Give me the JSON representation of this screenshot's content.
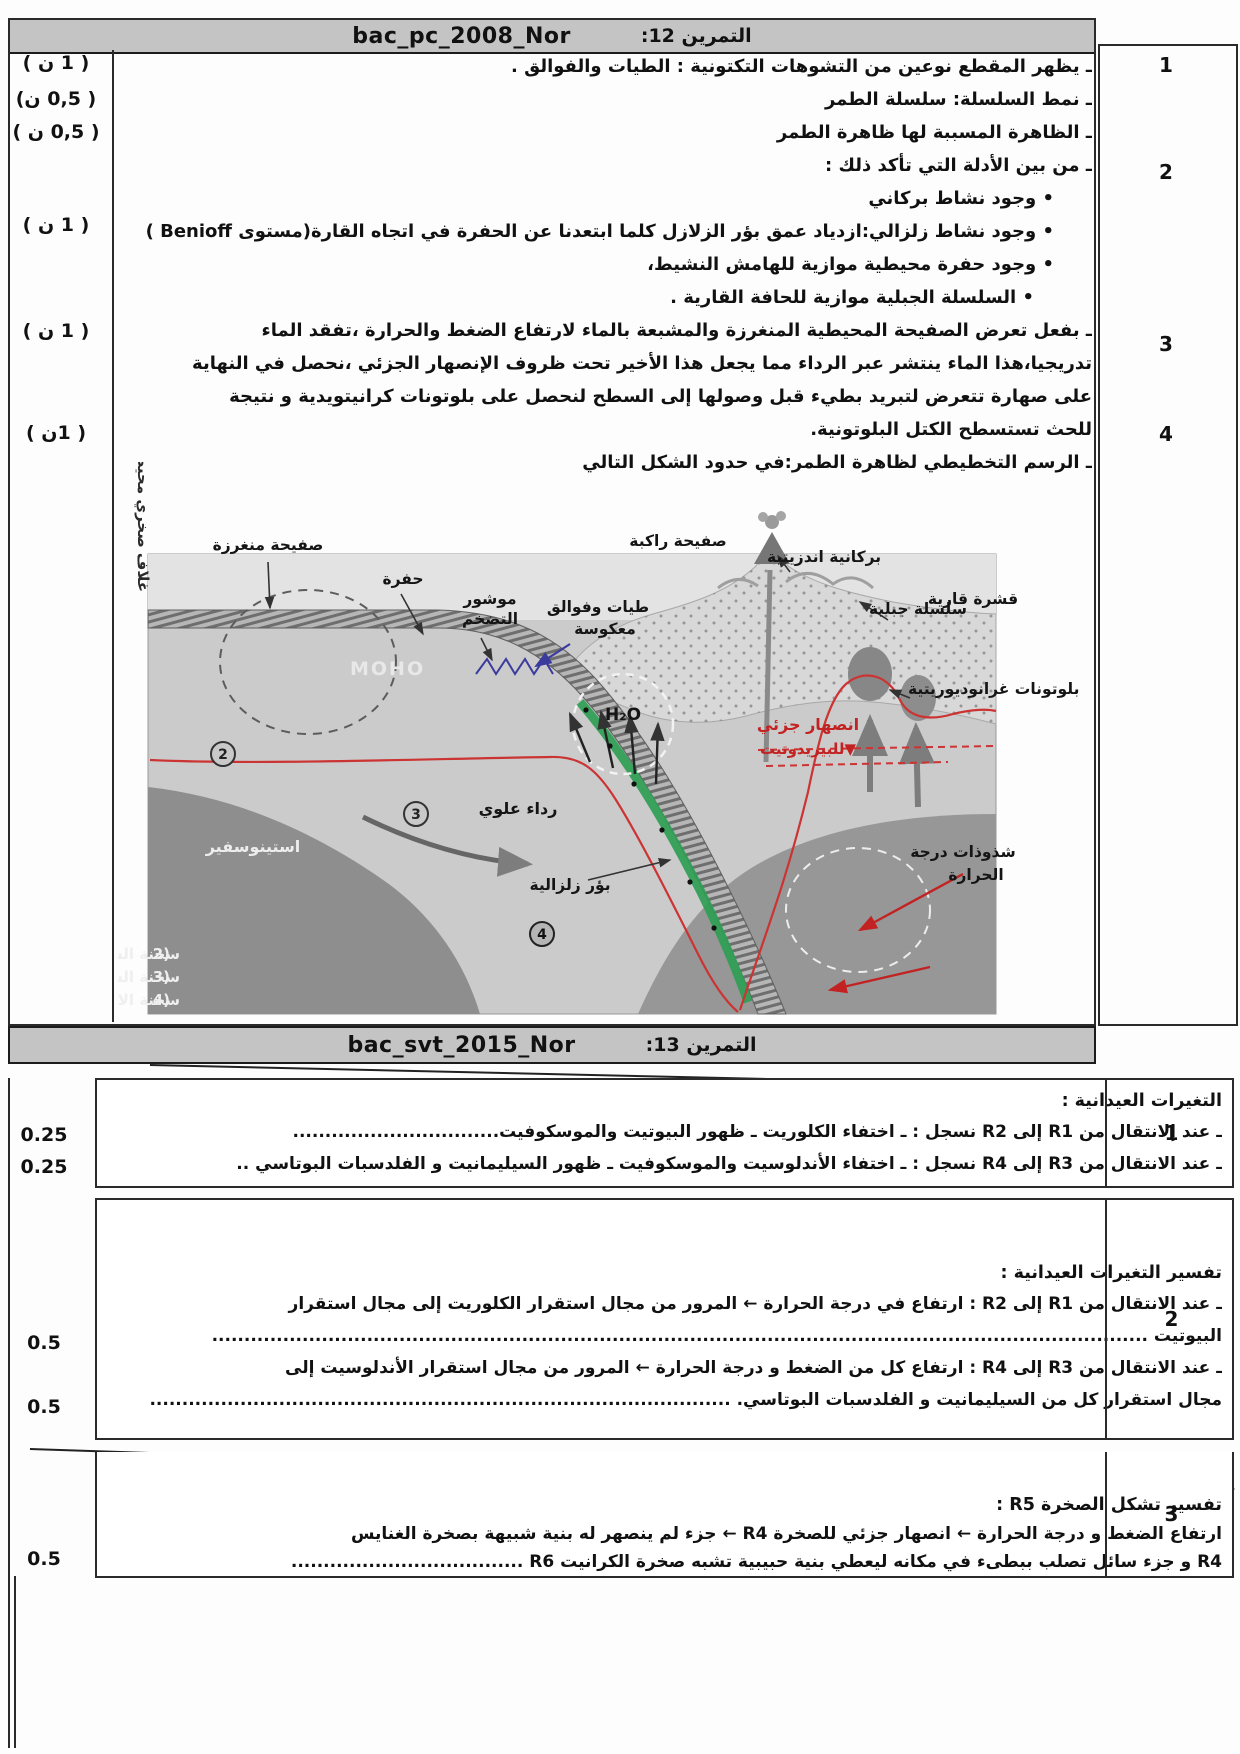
{
  "ex12": {
    "header": {
      "code": "bac_pc_2008_Nor",
      "label": "التمرين 12:"
    },
    "marks": [
      "( 1 ن )",
      "( 0,5 ن)",
      "( 0,5 ن )",
      "( 1 ن )",
      "( 1 ن )",
      "( 1ن )"
    ],
    "numbers": [
      "1",
      "2",
      "3",
      "4"
    ],
    "lines": [
      "ـ يظهر المقطع نوعين من التشوهات التكتونية : الطيات  والفوالق .",
      "ـ نمط السلسلة: سلسلة الطمر",
      "ـ  الظاهرة المسببة لها ظاهرة الطمر",
      "ـ من بين الأدلة التي تأكد ذلك :"
    ],
    "bullets": [
      "• وجود نشاط بركاني",
      "• وجود نشاط زلزالي:ازدياد عمق بؤر الزلازل كلما ابتعدنا عن الحفرة في اتجاه القارة(مستوى Benioff )",
      "• وجود حفرة محيطية موازية للهامش النشيط،",
      "•  السلسلة الجبلية موازية للحافة القارية ."
    ],
    "para": [
      "ـ بفعل تعرض الصفيحة المحيطية المنغرزة  والمشبعة بالماء لارتفاع الضغط والحرارة ،تفقد الماء",
      "تدريجيا،هذا الماء ينتشر عبر الرداء مما يجعل هذا الأخير تحت ظروف الإنصهار الجزئي ،نحصل في النهاية",
      "على صهارة  تتعرض لتبريد بطيء قبل وصولها إلى السطح لنحصل على بلوتونات كرانيتويدية و نتيجة",
      "للحث تستسطح الكتل البلوتونية.",
      "ـ الرسم التخطيطي لظاهرة الطمر:في حدود الشكل التالي"
    ],
    "diagram": {
      "plate_sub": "صفيحة منغرزة",
      "trench": "حفرة",
      "prism1": "موشور",
      "prism2": "التضخم",
      "folds1": "طيات وفوالق",
      "folds2": "معكوسة",
      "plate_over": "صفيحة راكبة",
      "volcanic": "بركانية اندزيتية",
      "chain": "سلسلة جبلية",
      "crust": "قشرة قارية",
      "plutons": "بلوتونات غرانوديوريتية",
      "melt1": "انصهار جزئي",
      "melt2": "▼للبيريدوتيت",
      "anomaly1": "شذوذات درجة",
      "anomaly2": "الحرارة",
      "h2o": "H₂O",
      "moho": "MOHO",
      "mantle": "رداء علوي",
      "foci": "بؤر زلزالية",
      "astheno": "استينوسفير",
      "litho": "غلاف صخري محيطي",
      "c2": "2",
      "c3": "3",
      "c4": "4",
      "legend": [
        {
          "num": "2)",
          "text": "سحنة الشيست الأخضر"
        },
        {
          "num": "3)",
          "text": "سحنة الشيست الازرق"
        },
        {
          "num": "4)",
          "text": "سحنة الاكلوجيت"
        }
      ]
    }
  },
  "ex13": {
    "header": {
      "code": "bac_svt_2015_Nor",
      "label": "التمرين 13:"
    },
    "rows": [
      {
        "num": "1",
        "title": "التغيرات العيدانية :",
        "lines": [
          {
            "text": "ـ عند إلانتقال من R1 إلى R2 نسجل : ـ اختفاء الكلوريت   ـ ظهور البيوتيت والموسكوفيت................................",
            "mark": "0.25"
          },
          {
            "text": "ـ عند الانتقال من R3 إلى R4 نسجل : ـ اختفاء الأندلوسيت والموسكوفيت   ـ ظهور السيليمانيت و الفلدسبات البوتاسي ..",
            "mark": "0.25"
          }
        ]
      },
      {
        "num": "2",
        "title": "تفسير التغيرات العيدانية :",
        "lines": [
          {
            "text": "ـ عند الانتقال من R1 إلى R2 : ارتفاع في درجة الحرارة   ←  المرور من مجال استقرار الكلوريت إلى مجال استقرار",
            "mark": ""
          },
          {
            "text": "البيوتيت .................................................................................................................................................",
            "mark": "0.5"
          },
          {
            "text": "ـ عند الانتقال من R3 إلى R4 : ارتفاع كل من الضغط و درجة الحرارة ← المرور من مجال استقرار الأندلوسيت إلى",
            "mark": ""
          },
          {
            "text": "مجال استقرار كل من السيليمانيت و الفلدسبات البوتاسي. ..........................................................................................",
            "mark": "0.5"
          }
        ]
      },
      {
        "num": "3",
        "title": "تفسير تشكل الصخرة R5 :",
        "lines": [
          {
            "text": "ارتفاع الضغط و درجة الحرارة ← انصهار جزئي للصخرة R4 ←  جزء لم ينصهر له بنية شبيهة بصخرة الغنايس",
            "mark": ""
          },
          {
            "text": "R4 و جزء سائل تصلب ببطىء في مكانه ليعطي بنية حبيبية تشبه صخرة الكرانيت R6 ....................................",
            "mark": "0.5"
          }
        ]
      }
    ]
  }
}
